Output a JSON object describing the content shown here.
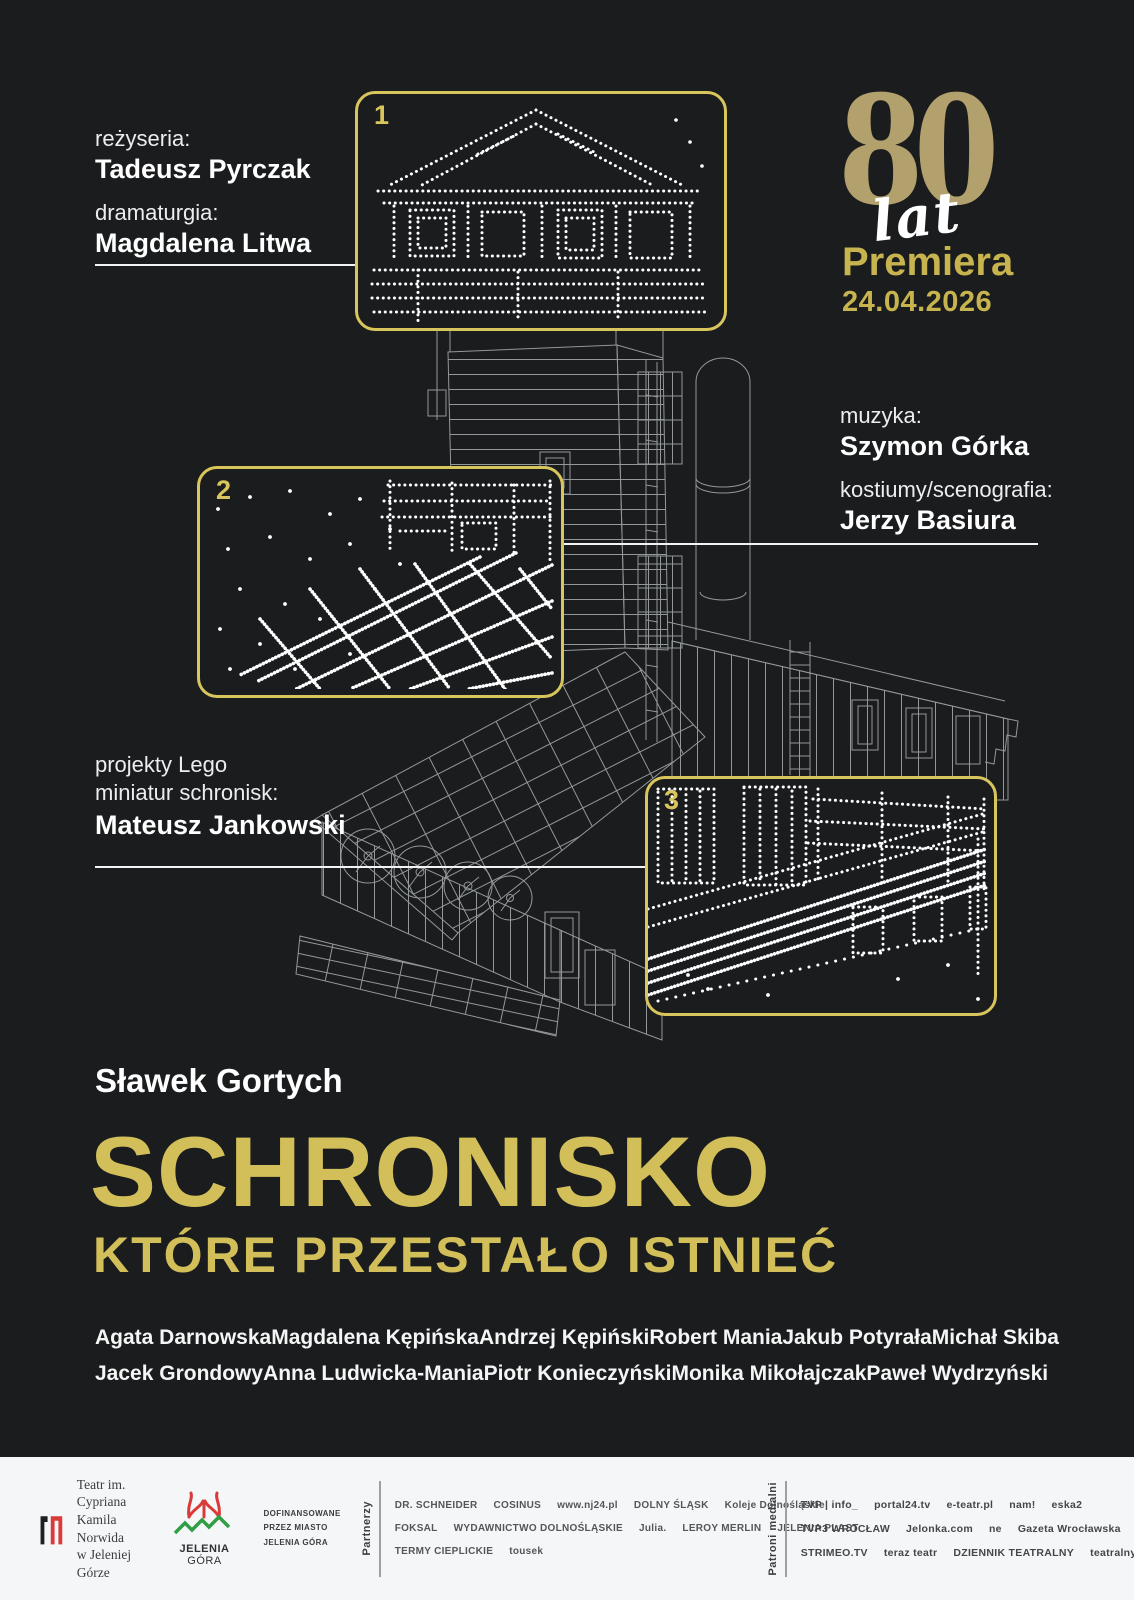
{
  "colors": {
    "background": "#1a1c1e",
    "gold_title": "#d2bf5a",
    "gold_premiere": "#c8b44e",
    "tan_80": "#b2a06d",
    "box_border": "#d8c55c",
    "white": "#f3f4f4",
    "footer_bg": "#f5f6f8",
    "wireframe": "#9ea3a6"
  },
  "credits": {
    "rezyseria_label": "reżyseria:",
    "rezyseria_name": "Tadeusz Pyrczak",
    "dramaturgia_label": "dramaturgia:",
    "dramaturgia_name": "Magdalena Litwa",
    "muzyka_label": "muzyka:",
    "muzyka_name": "Szymon Górka",
    "kostiumy_label": "kostiumy/scenografia:",
    "kostiumy_name": "Jerzy Basiura",
    "lego_label_line1": "projekty Lego",
    "lego_label_line2": "miniatur schronisk:",
    "lego_name": "Mateusz Jankowski"
  },
  "anniversary": {
    "number": "80",
    "unit": "lat",
    "premiere_label": "Premiera",
    "premiere_date": "24.04.2026"
  },
  "callouts": {
    "box1": "1",
    "box2": "2",
    "box3": "3"
  },
  "author": "Sławek Gortych",
  "title": {
    "line1": "SCHRONISKO",
    "line2": "KTÓRE PRZESTAŁO ISTNIEĆ"
  },
  "cast": {
    "row1": [
      "Agata Darnowska",
      "Magdalena Kępińska",
      "Andrzej Kępiński",
      "Robert Mania",
      "Jakub Potyrała",
      "Michał Skiba"
    ],
    "row2": [
      "Jacek Grondowy",
      "Anna Ludwicka-Mania",
      "Piotr Konieczyński",
      "Monika Mikołajczak",
      "Paweł Wydrzyński"
    ]
  },
  "footer": {
    "theater": {
      "line1": "Teatr im. Cypriana",
      "line2": "Kamila Norwida",
      "line3": "w Jeleniej Górze"
    },
    "city": {
      "name_bold": "JELENIA",
      "name_light": "GÓRA"
    },
    "funding": {
      "line1": "DOFINANSOWANE",
      "line2": "PRZEZ MIASTO",
      "line3": "JELENIA GÓRA"
    },
    "partners_label": "Partnerzy",
    "partners_row1": [
      "DR. SCHNEIDER",
      "COSINUS",
      "www.nj24.pl",
      "DOLNY ŚLĄSK",
      "Koleje Dolnośląskie"
    ],
    "partners_row2": [
      "FOKSAL",
      "WYDAWNICTWO DOLNOŚLĄSKIE",
      "Julia.",
      "LEROY MERLIN",
      "JELENIA PLAST"
    ],
    "partners_row3": [
      "TERMY CIEPLICKIE",
      "tousek"
    ],
    "media_label": "Patroni medialni",
    "media_row1": [
      "TVP | info_",
      "portal24.tv",
      "e-teatr.pl",
      "nam!",
      "eska2"
    ],
    "media_row2": [
      "TVP3 WROCŁAW",
      "Jelonka.com",
      "ne",
      "Gazeta Wrocławska",
      "CO JEST GRANE",
      "dami JELENIA GÓRA"
    ],
    "media_row3": [
      "STRIMEO.TV",
      "teraz teatr",
      "DZIENNIK TEATRALNY",
      "teatralny",
      "ZACHODNIA"
    ]
  }
}
